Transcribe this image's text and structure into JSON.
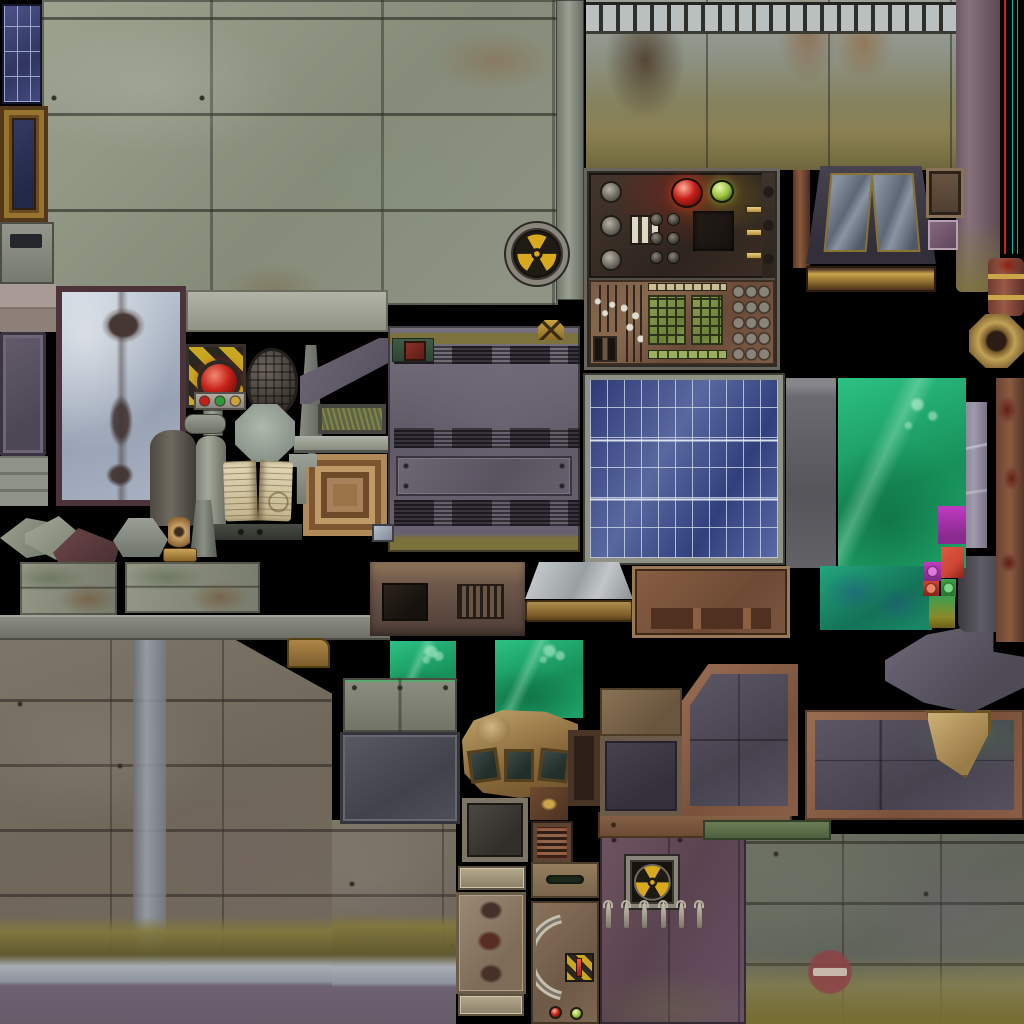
{
  "canvas": {
    "width": 1024,
    "height": 1024,
    "background": "#000000"
  },
  "atlas_description": "industrial sci-fi game texture atlas sheet",
  "palette": {
    "hazard-yellow": "#c8a820",
    "dome-red": "#c42018",
    "dome-green": "#9ac23c",
    "led-green": "#2e9a3c",
    "led-amber": "#c9a23a",
    "key-green": "#8aa050",
    "slime-green": "#23b377",
    "slime-teal": "#1d9a74",
    "solar-blue": "#3c4a86",
    "magenta": "#c03ac0",
    "red-square": "#cc4434",
    "green-square": "#3da048",
    "neon-red": "#cc2222",
    "neon-teal": "#28b09a",
    "neon-green": "#30aa44",
    "noentry-red": "#8e4246",
    "trefoil-yellow": "#d8a81f",
    "frame-gold": "#a08440"
  },
  "tiles": [
    {
      "name": "stone-block-wall",
      "kind": "stone",
      "r": [
        42,
        0,
        516,
        305
      ]
    },
    {
      "name": "grey-pillar-strip",
      "kind": "pillargrey",
      "r": [
        556,
        0,
        28,
        300
      ]
    },
    {
      "name": "upper-grass-wall",
      "kind": "mosswall",
      "r": [
        586,
        0,
        370,
        170
      ]
    },
    {
      "name": "mauve-pillar",
      "kind": "mauvepillar",
      "r": [
        956,
        0,
        44,
        292
      ]
    },
    {
      "name": "neon-light-strips",
      "kind": "neon",
      "r": [
        1000,
        0,
        24,
        254
      ]
    },
    {
      "name": "solar-cell-strip",
      "kind": "bluegrid",
      "r": [
        2,
        4,
        40,
        100
      ]
    },
    {
      "name": "picture-frame",
      "kind": "frame",
      "r": [
        0,
        106,
        48,
        116
      ]
    },
    {
      "name": "block-with-slot",
      "kind": "blockslot",
      "r": [
        0,
        222,
        54,
        62
      ]
    },
    {
      "name": "pink-block-texture",
      "kind": "pinkblocks",
      "r": [
        0,
        284,
        56,
        48
      ]
    },
    {
      "name": "purple-wall-panel",
      "kind": "purplepanel",
      "r": [
        0,
        332,
        46,
        124
      ]
    },
    {
      "name": "frosted-glass-panel",
      "kind": "frost",
      "r": [
        56,
        286,
        130,
        220
      ]
    },
    {
      "name": "metal-strip-stack",
      "kind": "strips",
      "r": [
        0,
        456,
        48,
        50
      ]
    },
    {
      "name": "machine-wall",
      "kind": "machinewall",
      "r": [
        388,
        326,
        192,
        226
      ]
    },
    {
      "name": "riveted-access-panel",
      "kind": "rivetedpanel",
      "r": [
        396,
        456,
        176,
        40
      ]
    },
    {
      "name": "light-concrete-beam",
      "kind": "slab",
      "r": [
        186,
        290,
        202,
        42
      ]
    },
    {
      "name": "long-metal-bar",
      "kind": "longbar",
      "r": [
        0,
        615,
        390,
        25
      ]
    },
    {
      "name": "bottom-left-wall",
      "kind": "wallbla",
      "r": [
        0,
        640,
        332,
        384
      ]
    },
    {
      "name": "bottom-left-wall-ext",
      "kind": "wallblb",
      "r": [
        332,
        820,
        124,
        204
      ]
    },
    {
      "name": "rust-door",
      "kind": "door",
      "r": [
        600,
        830,
        146,
        194
      ]
    },
    {
      "name": "bottom-right-wall",
      "kind": "wallbr",
      "r": [
        746,
        834,
        278,
        190
      ]
    },
    {
      "name": "rust-base-strip",
      "kind": "basestrip",
      "r": [
        598,
        812,
        194,
        26
      ]
    },
    {
      "name": "green-bar",
      "kind": "greenbar",
      "r": [
        703,
        820,
        128,
        20
      ]
    },
    {
      "name": "chamfered-panel",
      "kind": "chamferpanel",
      "r": [
        680,
        664,
        118,
        152
      ]
    },
    {
      "name": "large-right-panel",
      "kind": "bigpanel",
      "r": [
        805,
        710,
        219,
        110
      ]
    },
    {
      "name": "small-brown-plate",
      "kind": "platebrown",
      "r": [
        600,
        688,
        82,
        48
      ]
    },
    {
      "name": "small-framed-panel",
      "kind": "framedsm",
      "r": [
        600,
        736,
        82,
        80
      ]
    },
    {
      "name": "pipe-elbow",
      "kind": "pipeelbow",
      "r": [
        885,
        628,
        139,
        85
      ]
    },
    {
      "name": "dark-pipe",
      "kind": "darkpipe",
      "r": [
        958,
        556,
        58,
        76
      ]
    },
    {
      "name": "lavender-strip",
      "kind": "lavender",
      "r": [
        963,
        402,
        24,
        146
      ]
    },
    {
      "name": "rust-pillar-right",
      "kind": "rustpillarR",
      "r": [
        996,
        378,
        28,
        264
      ]
    },
    {
      "name": "dark-slab",
      "kind": "darkslab",
      "r": [
        786,
        378,
        50,
        190
      ]
    },
    {
      "name": "toxic-slime-large",
      "kind": "slime",
      "r": [
        838,
        378,
        128,
        190
      ]
    },
    {
      "name": "toxic-slime-teal",
      "kind": "slimeteal",
      "r": [
        820,
        566,
        112,
        64
      ]
    },
    {
      "name": "solar-panel",
      "kind": "solar",
      "r": [
        585,
        375,
        198,
        188
      ]
    },
    {
      "name": "swatch-magenta",
      "kind": "sqmagenta",
      "r": [
        938,
        506,
        28,
        38
      ]
    },
    {
      "name": "swatch-red",
      "kind": "sqred",
      "r": [
        941,
        547,
        23,
        31
      ]
    },
    {
      "name": "swatch-magenta-small",
      "kind": "sqmagsm",
      "r": [
        924,
        562,
        17,
        19
      ]
    },
    {
      "name": "swatch-red-small",
      "kind": "sqredsm",
      "r": [
        923,
        581,
        16,
        15
      ]
    },
    {
      "name": "swatch-green-small",
      "kind": "sqgreensm",
      "r": [
        941,
        579,
        15,
        18
      ]
    },
    {
      "name": "olive-gradient-strip",
      "kind": "olivestrip",
      "r": [
        929,
        596,
        26,
        32
      ]
    },
    {
      "name": "control-panel",
      "kind": "controlpanel",
      "r": [
        584,
        168,
        196,
        202
      ]
    },
    {
      "name": "window-rust-pillar",
      "kind": "rustpillarW",
      "r": [
        793,
        170,
        17,
        98
      ]
    },
    {
      "name": "factory-window",
      "kind": "windowt",
      "r": [
        806,
        166,
        130,
        126
      ]
    },
    {
      "name": "small-brown-panel",
      "kind": "brownsm",
      "r": [
        926,
        168,
        38,
        50
      ]
    },
    {
      "name": "purple-square",
      "kind": "purplesq",
      "r": [
        928,
        220,
        30,
        30
      ]
    },
    {
      "name": "red-pipe-gold-rings",
      "kind": "pipered",
      "r": [
        988,
        258,
        36,
        58
      ]
    },
    {
      "name": "hex-pipe-end",
      "kind": "hexnut",
      "r": [
        969,
        314,
        55,
        54
      ]
    },
    {
      "name": "wall-radiation-fan",
      "kind": "fanround",
      "r": [
        506,
        223,
        62,
        62
      ]
    },
    {
      "name": "hazard-stripe-button",
      "kind": "hazard",
      "r": [
        186,
        344,
        60,
        64
      ]
    },
    {
      "name": "indicator-led-bar",
      "kind": "ledbar",
      "r": [
        194,
        392,
        52,
        18
      ]
    },
    {
      "name": "led-bar-stem",
      "kind": "pillargrey",
      "r": [
        203,
        410,
        20,
        26
      ]
    },
    {
      "name": "mesh-dome",
      "kind": "dome",
      "r": [
        246,
        348,
        52,
        68
      ]
    },
    {
      "name": "tapered-pillar",
      "kind": "wedgepillar",
      "r": [
        299,
        345,
        24,
        112
      ]
    },
    {
      "name": "sloped-roof-piece",
      "kind": "slopedroof",
      "r": [
        300,
        338,
        88,
        66
      ]
    },
    {
      "name": "grass-planter-frame",
      "kind": "grassframe",
      "r": [
        318,
        404,
        68,
        30
      ]
    },
    {
      "name": "stone-ledge",
      "kind": "ledge",
      "r": [
        294,
        436,
        94,
        17
      ]
    },
    {
      "name": "bronze-cornice",
      "kind": "cornice",
      "r": [
        303,
        454,
        84,
        82
      ]
    },
    {
      "name": "t-bracket",
      "kind": "tbracket",
      "r": [
        289,
        454,
        28,
        50
      ]
    },
    {
      "name": "stone-octagon",
      "kind": "octagon",
      "r": [
        235,
        404,
        60,
        58
      ]
    },
    {
      "name": "horizontal-pipe",
      "kind": "pipeh",
      "r": [
        184,
        414,
        42,
        20
      ]
    },
    {
      "name": "dark-pillar",
      "kind": "pillardark",
      "r": [
        150,
        430,
        46,
        96
      ]
    },
    {
      "name": "grey-pillar",
      "kind": "pillargrey2",
      "r": [
        196,
        436,
        30,
        92
      ]
    },
    {
      "name": "open-book",
      "kind": "book",
      "r": [
        224,
        458,
        68,
        68
      ]
    },
    {
      "name": "dark-shelf",
      "kind": "shelf",
      "r": [
        208,
        524,
        94,
        16
      ]
    },
    {
      "name": "glass-square",
      "kind": "glasssq",
      "r": [
        372,
        524,
        22,
        18
      ]
    },
    {
      "name": "red-box-pedestal",
      "kind": "redbox",
      "r": [
        392,
        338,
        42,
        24
      ]
    },
    {
      "name": "radiation-plaque",
      "kind": "radplaque",
      "r": [
        538,
        320,
        26,
        20
      ]
    },
    {
      "name": "chevron-shard",
      "kind": "chev",
      "r": [
        0,
        518,
        48,
        40
      ]
    },
    {
      "name": "arrow-shard",
      "kind": "arrow",
      "r": [
        25,
        516,
        52,
        44
      ]
    },
    {
      "name": "maroon-shard",
      "kind": "pent",
      "r": [
        53,
        528,
        67,
        59
      ]
    },
    {
      "name": "bell-shard",
      "kind": "bell",
      "r": [
        113,
        518,
        55,
        39
      ]
    },
    {
      "name": "tan-starburst",
      "kind": "starburst",
      "r": [
        168,
        517,
        22,
        33
      ]
    },
    {
      "name": "tall-shard",
      "kind": "tallshard",
      "r": [
        190,
        500,
        27,
        57
      ]
    },
    {
      "name": "gold-bar",
      "kind": "goldbar",
      "r": [
        163,
        548,
        34,
        14
      ]
    },
    {
      "name": "stained-plates-left",
      "kind": "platesl",
      "r": [
        20,
        562,
        97,
        53
      ]
    },
    {
      "name": "stained-plates-right",
      "kind": "platesr",
      "r": [
        125,
        562,
        135,
        51
      ]
    },
    {
      "name": "brown-console",
      "kind": "consolebrown",
      "r": [
        370,
        562,
        155,
        74
      ]
    },
    {
      "name": "metal-tray",
      "kind": "tray",
      "r": [
        525,
        562,
        108,
        60
      ]
    },
    {
      "name": "vent-panel-brown",
      "kind": "ventpanel",
      "r": [
        632,
        566,
        158,
        72
      ]
    },
    {
      "name": "slime-square-a",
      "kind": "slimesq",
      "r": [
        390,
        641,
        66,
        76
      ]
    },
    {
      "name": "slime-square-b",
      "kind": "slimesq",
      "r": [
        495,
        640,
        88,
        78
      ]
    },
    {
      "name": "gold-pipe-elbow",
      "kind": "pipegold",
      "r": [
        287,
        638,
        43,
        30
      ]
    },
    {
      "name": "mossy-plate",
      "kind": "mossplate",
      "r": [
        343,
        678,
        114,
        54
      ]
    },
    {
      "name": "dark-plate",
      "kind": "darkplate",
      "r": [
        340,
        732,
        120,
        92
      ]
    },
    {
      "name": "curved-console",
      "kind": "curvedconsole",
      "r": [
        462,
        710,
        116,
        88
      ]
    },
    {
      "name": "framed-plate",
      "kind": "framedplate",
      "r": [
        462,
        798,
        66,
        64
      ]
    },
    {
      "name": "rust-gold-square",
      "kind": "rustgold",
      "r": [
        530,
        787,
        38,
        33
      ]
    },
    {
      "name": "dark-frame-small",
      "kind": "darkframesm",
      "r": [
        568,
        730,
        32,
        76
      ]
    },
    {
      "name": "red-vent-grille",
      "kind": "ventred",
      "r": [
        533,
        823,
        38,
        39
      ]
    },
    {
      "name": "label-plate-top",
      "kind": "labelplate",
      "r": [
        458,
        866,
        68,
        24
      ]
    },
    {
      "name": "burn-blob-plate",
      "kind": "blobplate",
      "r": [
        456,
        892,
        70,
        102
      ]
    },
    {
      "name": "label-plate-bottom",
      "kind": "labelplate",
      "r": [
        458,
        994,
        66,
        22
      ]
    },
    {
      "name": "lever-panel",
      "kind": "leverpanel",
      "r": [
        531,
        862,
        68,
        162
      ]
    },
    {
      "name": "door-radiation-fan",
      "kind": "fansquare",
      "r": [
        626,
        856,
        52,
        52
      ]
    },
    {
      "name": "hook-row",
      "kind": "hooks",
      "r": [
        606,
        902,
        96,
        26
      ]
    },
    {
      "name": "no-entry-sign",
      "kind": "noentry",
      "r": [
        808,
        950,
        44,
        44
      ]
    }
  ]
}
